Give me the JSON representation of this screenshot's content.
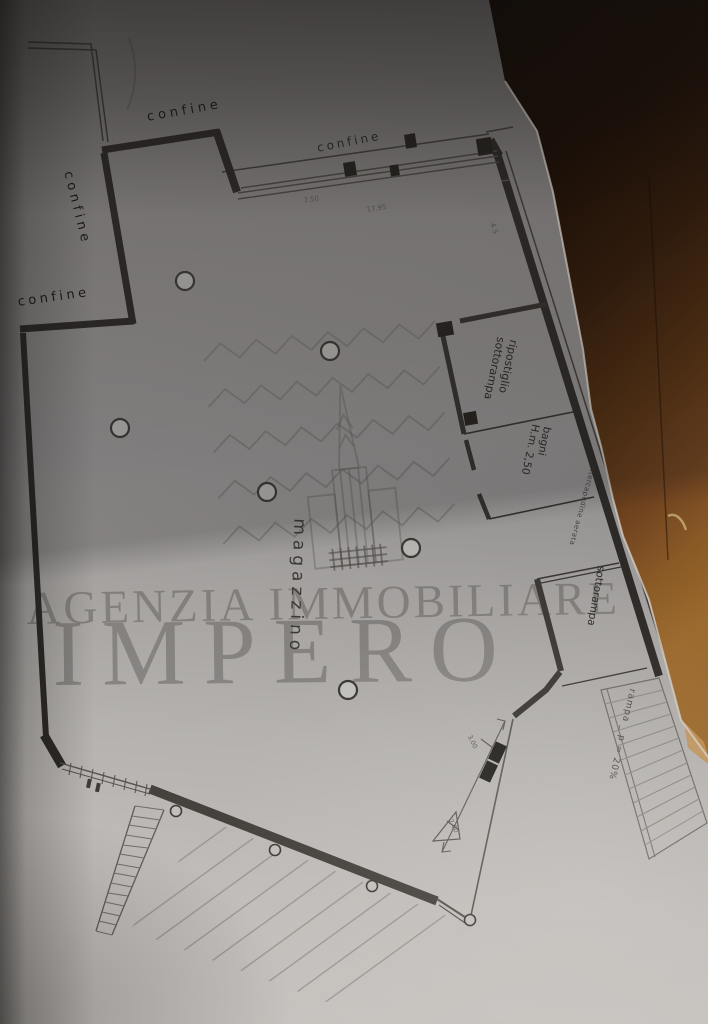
{
  "watermark": {
    "agency_line": "AGENZIA IMMOBILIARE",
    "brand": "IMPERO"
  },
  "plan": {
    "area_label": "magazzino",
    "boundary_label": "confine",
    "rooms": {
      "ripostiglio": {
        "line1": "ripostiglio",
        "line2": "sottorampa"
      },
      "bagni": {
        "line1": "bagni",
        "line2": "H.m. 2,50"
      },
      "sottorampa": "sottorampa"
    },
    "wall_note": "intercapedine aerata",
    "ramp_label": "rampa _ p = 20%",
    "dimensions": {
      "top1": "7.50",
      "top2": "17.95",
      "side": "4.5",
      "door_upper": "3.00",
      "door_lower": "2.60"
    }
  },
  "colors": {
    "paper_light": "#c7c3bf",
    "paper_dark": "#6e6b6a",
    "table_wood_dark": "#150b04",
    "table_wood_light": "#9a682c",
    "ink": "#2c2927",
    "watermark_gray": "#8d8a88"
  }
}
